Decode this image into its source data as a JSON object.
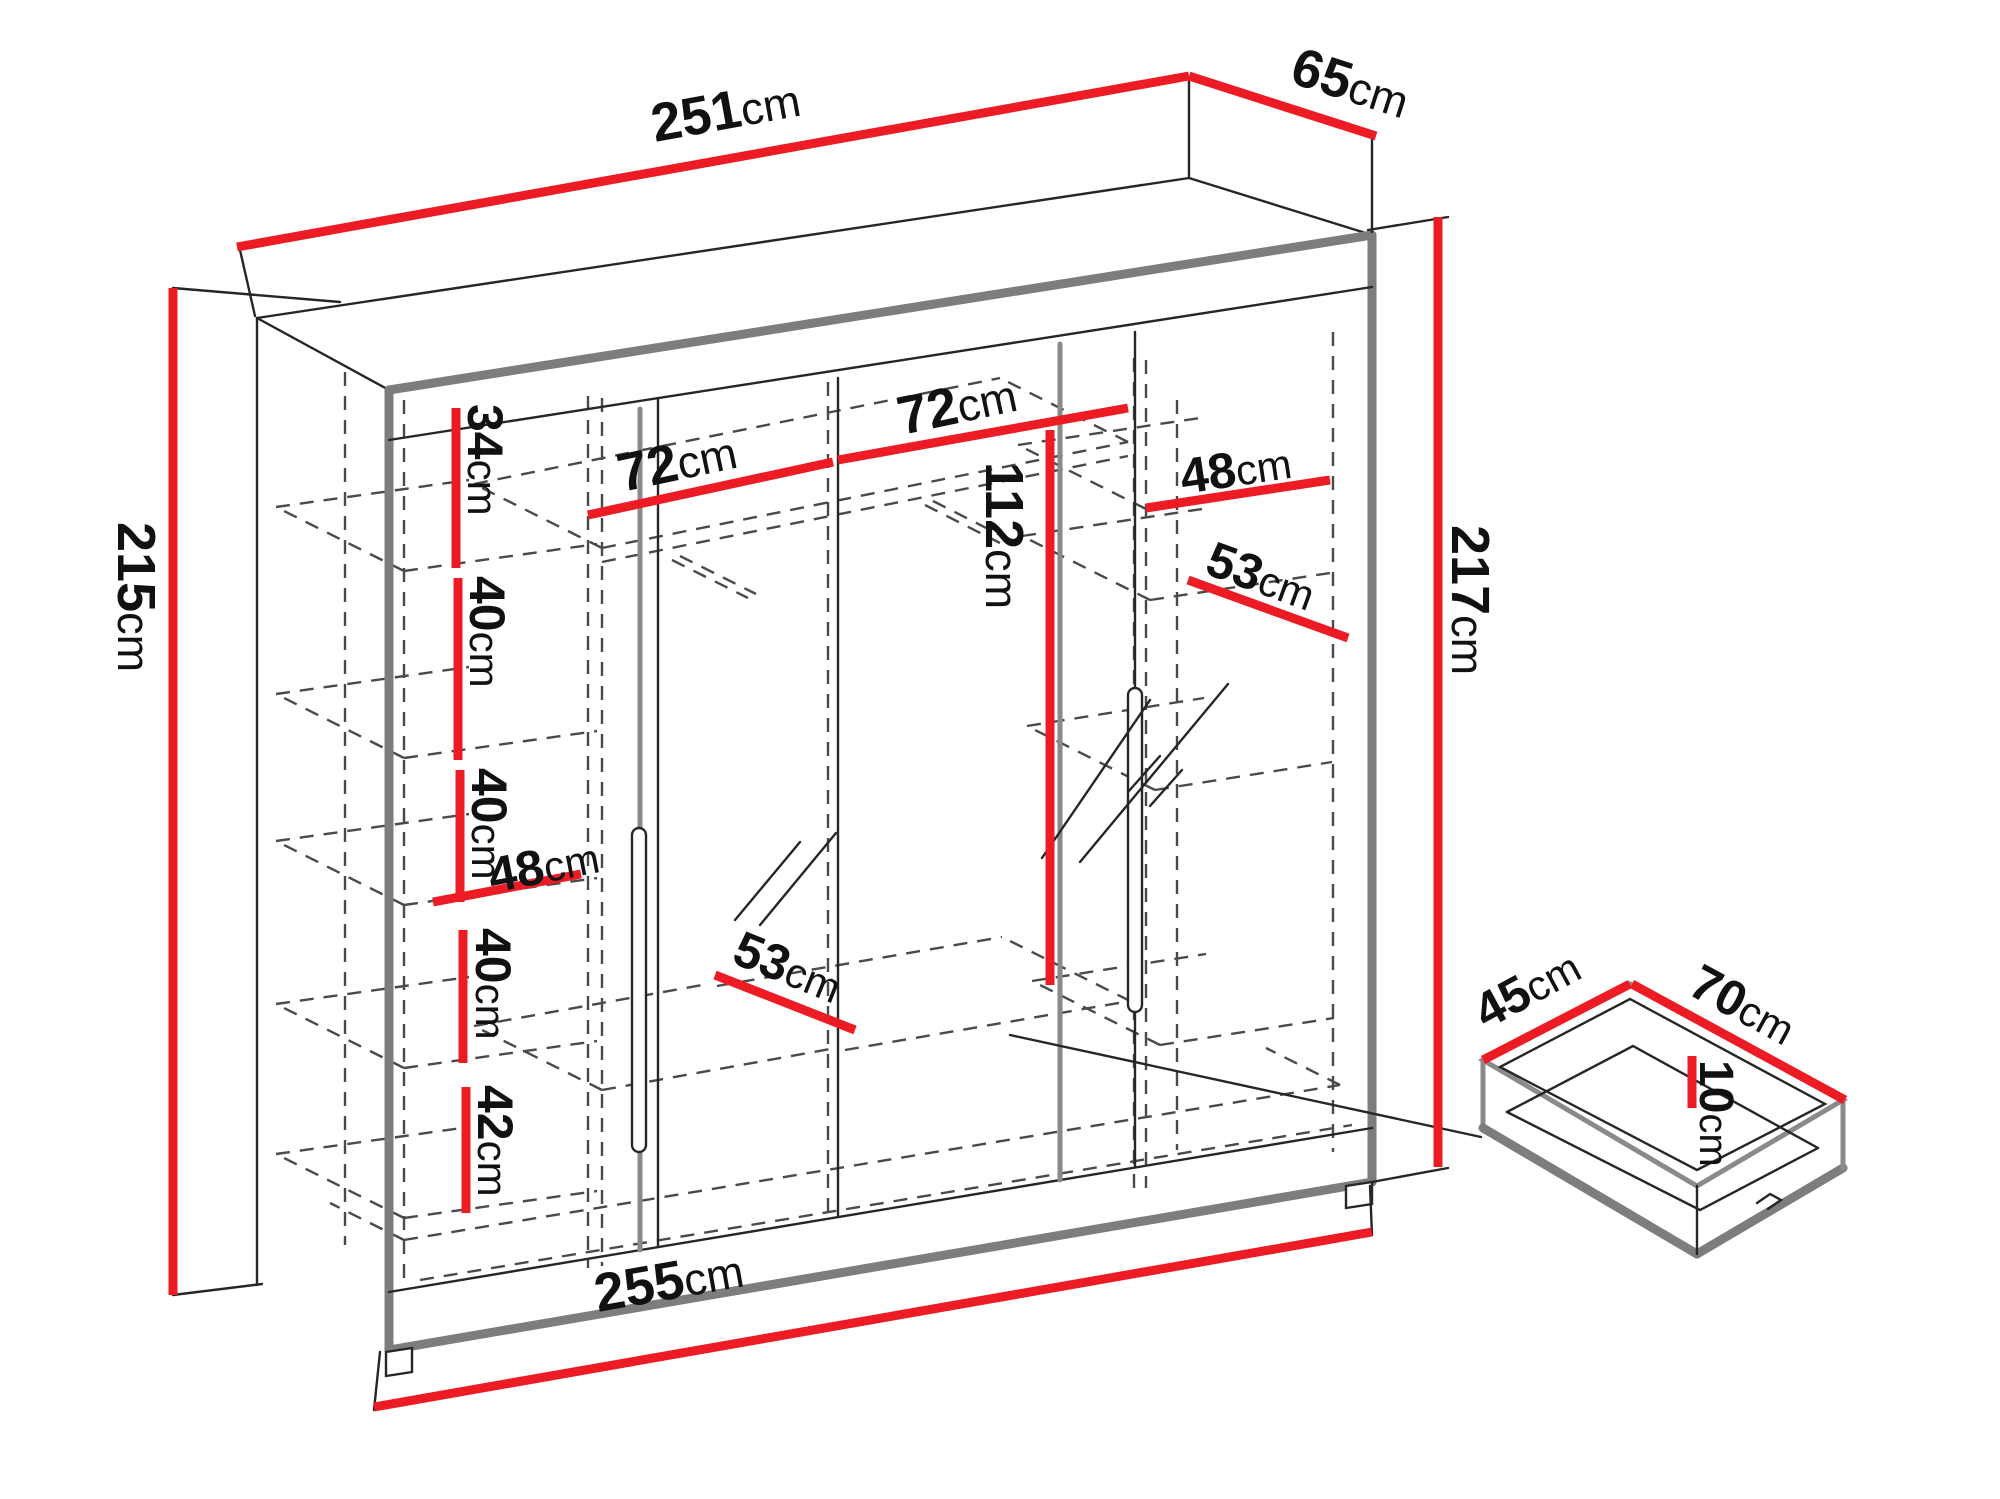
{
  "colors": {
    "dimension_red": "#ED1C24",
    "outline_gray": "#7d7d7d",
    "line_black": "#262626",
    "background": "#ffffff"
  },
  "diagram": {
    "type": "furniture-dimension-drawing",
    "subject": "wardrobe-with-sliding-mirror-doors-and-drawer",
    "unit": "cm",
    "overall": {
      "top_width": "251cm",
      "top_depth": "65cm",
      "left_height": "215cm",
      "right_height": "217cm",
      "bottom_width": "255cm"
    },
    "interior": {
      "left_column_sections": [
        "34cm",
        "40cm",
        "40cm",
        "40cm",
        "42cm"
      ],
      "left_column_width": "48cm",
      "middle_section_widths": [
        "72cm",
        "72cm"
      ],
      "hanging_height": "112cm",
      "right_column_shelf_width": "48cm",
      "right_column_depth": "53cm",
      "bottom_depth": "53cm"
    },
    "drawer": {
      "depth": "45cm",
      "width": "70cm",
      "height": "10cm"
    },
    "labels": [
      {
        "id": "width-top",
        "value": "251",
        "unit": "cm",
        "x": 655,
        "y": 142,
        "rotate": -10.3,
        "size": 54
      },
      {
        "id": "depth-top",
        "value": "65",
        "unit": "cm",
        "x": 1288,
        "y": 82,
        "rotate": 17.8,
        "size": 54
      },
      {
        "id": "height-left",
        "value": "215",
        "unit": "cm",
        "x": 118,
        "y": 522,
        "rotate": 90,
        "size": 54
      },
      {
        "id": "height-right",
        "value": "217",
        "unit": "cm",
        "x": 1452,
        "y": 525,
        "rotate": 90,
        "size": 54
      },
      {
        "id": "shelf-gap-1",
        "value": "34",
        "unit": "cm",
        "x": 468,
        "y": 404,
        "rotate": 90,
        "size": 50
      },
      {
        "id": "shelf-gap-2",
        "value": "40",
        "unit": "cm",
        "x": 470,
        "y": 576,
        "rotate": 90,
        "size": 50
      },
      {
        "id": "shelf-gap-3",
        "value": "40",
        "unit": "cm",
        "x": 472,
        "y": 768,
        "rotate": 90,
        "size": 50
      },
      {
        "id": "shelf-width-left",
        "value": "48",
        "unit": "cm",
        "x": 492,
        "y": 893,
        "rotate": -11,
        "size": 50
      },
      {
        "id": "shelf-gap-4",
        "value": "40",
        "unit": "cm",
        "x": 476,
        "y": 928,
        "rotate": 90,
        "size": 50
      },
      {
        "id": "shelf-gap-5",
        "value": "42",
        "unit": "cm",
        "x": 478,
        "y": 1085,
        "rotate": 90,
        "size": 50
      },
      {
        "id": "compartment-left",
        "value": "72",
        "unit": "cm",
        "x": 622,
        "y": 492,
        "rotate": -12,
        "size": 54
      },
      {
        "id": "compartment-right",
        "value": "72",
        "unit": "cm",
        "x": 902,
        "y": 435,
        "rotate": -12,
        "size": 54
      },
      {
        "id": "hanging-height",
        "value": "112",
        "unit": "cm",
        "x": 986,
        "y": 462,
        "rotate": 90,
        "size": 54
      },
      {
        "id": "shelf-width-right",
        "value": "48",
        "unit": "cm",
        "x": 1183,
        "y": 494,
        "rotate": -8.5,
        "size": 50
      },
      {
        "id": "shelf-depth-right",
        "value": "53",
        "unit": "cm",
        "x": 1203,
        "y": 573,
        "rotate": 20,
        "size": 50
      },
      {
        "id": "bottom-depth",
        "value": "53",
        "unit": "cm",
        "x": 730,
        "y": 962,
        "rotate": 22,
        "size": 50
      },
      {
        "id": "width-bottom",
        "value": "255",
        "unit": "cm",
        "x": 598,
        "y": 1312,
        "rotate": -10,
        "size": 54
      },
      {
        "id": "drawer-depth",
        "value": "45",
        "unit": "cm",
        "x": 1486,
        "y": 1030,
        "rotate": -28.5,
        "size": 50
      },
      {
        "id": "drawer-width",
        "value": "70",
        "unit": "cm",
        "x": 1686,
        "y": 993,
        "rotate": 28.5,
        "size": 50
      },
      {
        "id": "drawer-height",
        "value": "10",
        "unit": "cm",
        "x": 1700,
        "y": 1060,
        "rotate": 90,
        "size": 48
      }
    ]
  }
}
